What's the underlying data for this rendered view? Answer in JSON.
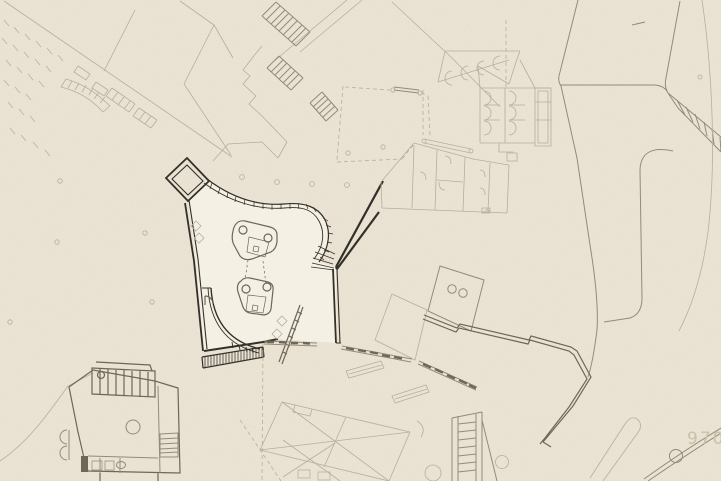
{
  "drawing": {
    "kind": "architectural site plan",
    "annotation_label": "9700",
    "colors": {
      "paper": "#ebe3d3",
      "light": "#b7ae9c",
      "mid": "#938b79",
      "middark": "#6e6759",
      "dark": "#33302a",
      "floor": "#f4f0e3",
      "label": "#cbc1a9"
    }
  }
}
